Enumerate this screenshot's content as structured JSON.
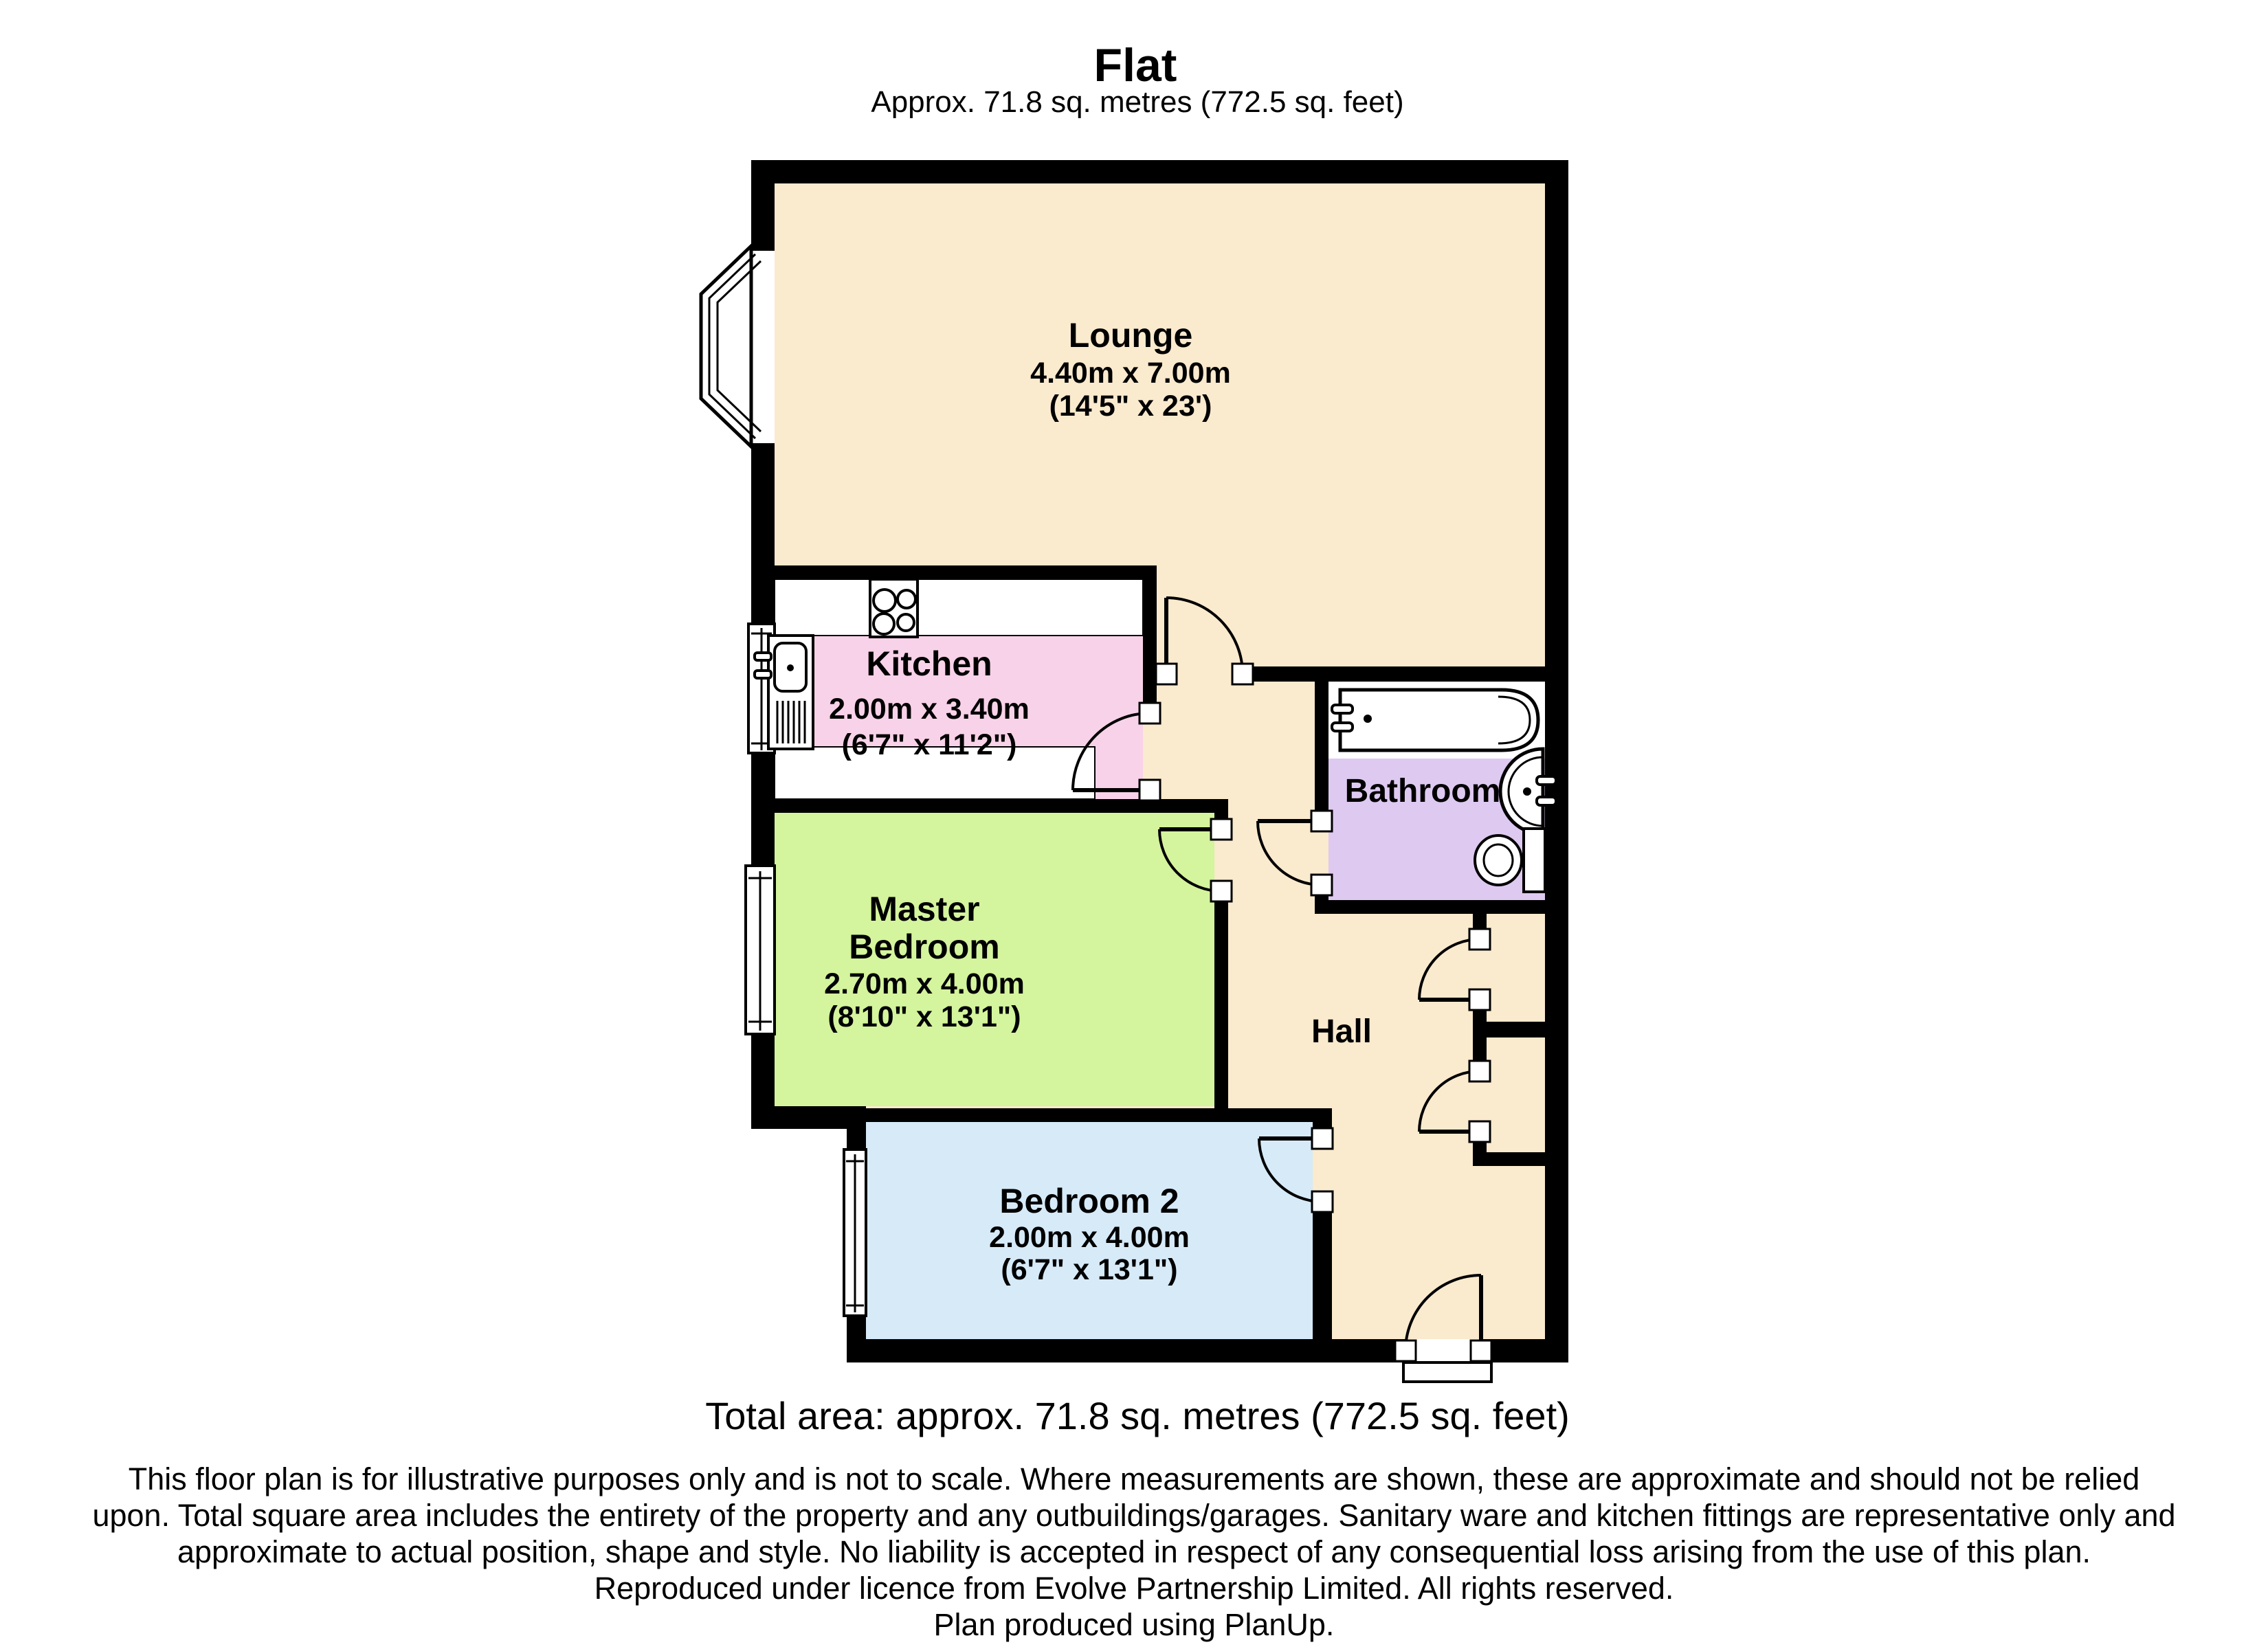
{
  "page": {
    "title": "Flat",
    "subtitle": "Approx.  71.8 sq. metres (772.5 sq. feet)",
    "total_area": "Total area: approx.  71.8 sq. metres (772.5 sq. feet)",
    "footer_lines": [
      "This floor plan is for illustrative purposes only and is not to scale.  Where measurements are shown, these are approximate and should not be relied",
      "upon. Total square area includes the entirety of the property and any outbuildings/garages. Sanitary ware and kitchen fittings are representative only and",
      "approximate to actual position, shape and style.  No liability is accepted in respect of any consequential loss arising from the use of this plan.",
      "Reproduced under licence from Evolve Partnership Limited. All rights reserved.",
      "Plan produced using PlanUp."
    ]
  },
  "rooms": {
    "lounge": {
      "name": "Lounge",
      "metric": "4.40m x 7.00m",
      "imperial": "(14'5\" x 23')"
    },
    "kitchen": {
      "name": "Kitchen",
      "metric": "2.00m x 3.40m",
      "imperial": "(6'7\" x 11'2\")"
    },
    "master_bedroom": {
      "name_line1": "Master",
      "name_line2": "Bedroom",
      "metric": "2.70m x 4.00m",
      "imperial": "(8'10\" x 13'1\")"
    },
    "bedroom2": {
      "name": "Bedroom 2",
      "metric": "2.00m x 4.00m",
      "imperial": "(6'7\" x 13'1\")"
    },
    "bathroom": {
      "name": "Bathroom"
    },
    "hall": {
      "name": "Hall"
    }
  },
  "colors": {
    "lounge_hall": "#FAEACE",
    "kitchen": "#F8D2E8",
    "master_bedroom": "#D4F49D",
    "bedroom2": "#D6EAF8",
    "bathroom": "#DEC9F1",
    "wall": "#000000"
  }
}
